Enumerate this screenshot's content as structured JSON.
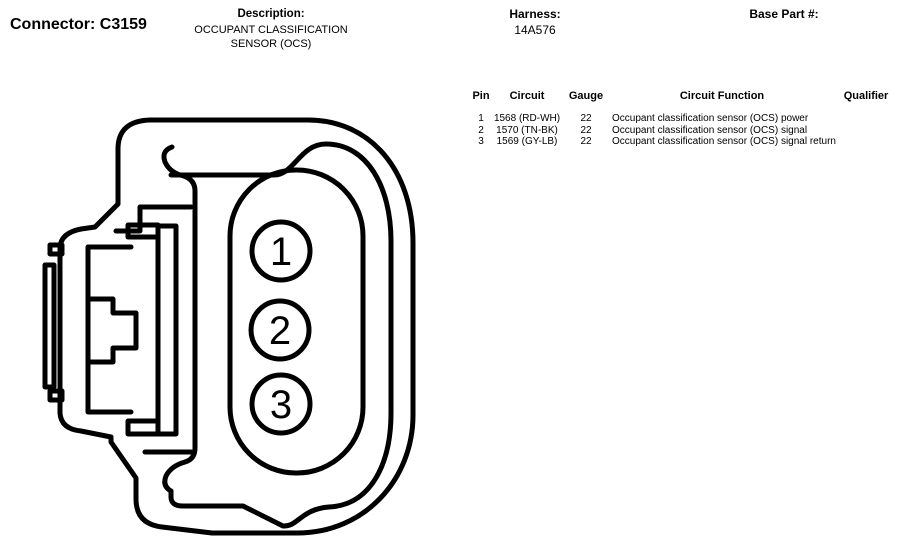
{
  "header": {
    "connector": "Connector: C3159",
    "description_label": "Description:",
    "description_line1": "OCCUPANT CLASSIFICATION",
    "description_line2": "SENSOR (OCS)",
    "harness_label": "Harness:",
    "harness_value": "14A576",
    "base_part_label": "Base Part #:",
    "base_part_value": ""
  },
  "pin_table": {
    "headers": {
      "pin": "Pin",
      "circuit": "Circuit",
      "gauge": "Gauge",
      "function": "Circuit Function",
      "qualifier": "Qualifier"
    },
    "rows": [
      {
        "pin": "1",
        "circuit": "1568 (RD-WH)",
        "gauge": "22",
        "function": "Occupant classification sensor (OCS) power",
        "qualifier": ""
      },
      {
        "pin": "2",
        "circuit": "1570 (TN-BK)",
        "gauge": "22",
        "function": "Occupant classification sensor (OCS) signal",
        "qualifier": ""
      },
      {
        "pin": "3",
        "circuit": "1569 (GY-LB)",
        "gauge": "22",
        "function": "Occupant classification sensor (OCS) signal return",
        "qualifier": ""
      }
    ]
  },
  "diagram": {
    "pins": [
      "1",
      "2",
      "3"
    ],
    "line_color": "#000000",
    "background": "#ffffff"
  }
}
